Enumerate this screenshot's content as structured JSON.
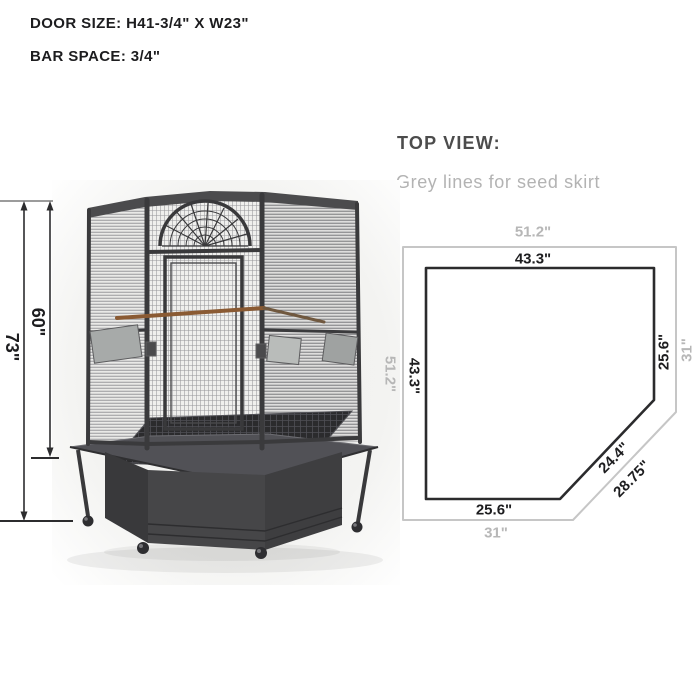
{
  "specs": {
    "door_size": "DOOR SIZE: H41-3/4\" X W23\"",
    "bar_space": "BAR SPACE: 3/4\""
  },
  "cage_figure": {
    "height_total": "73\"",
    "height_cage": "60\"",
    "colors": {
      "arrow": "#2c2c2e",
      "tick_grey": "#9c9c9c",
      "frame": "#3a3a3c",
      "perch_wood": "#8a5a33",
      "base": "#47474a"
    }
  },
  "top_view": {
    "title": "TOP VIEW:",
    "subtitle": "Grey lines for seed skirt",
    "inner": {
      "top": "43.3\"",
      "left": "43.3\"",
      "right": "25.6\"",
      "bottom": "25.6\"",
      "diagonal": "24.4\""
    },
    "outer": {
      "top": "51.2\"",
      "left": "51.2\"",
      "right": "31\"",
      "bottom": "31\"",
      "diagonal": "28.75\""
    },
    "colors": {
      "inner_line": "#2b2b2d",
      "outer_line": "#c6c6c6",
      "label_dark": "#1d1d1f",
      "label_grey": "#b7b7b7"
    }
  }
}
